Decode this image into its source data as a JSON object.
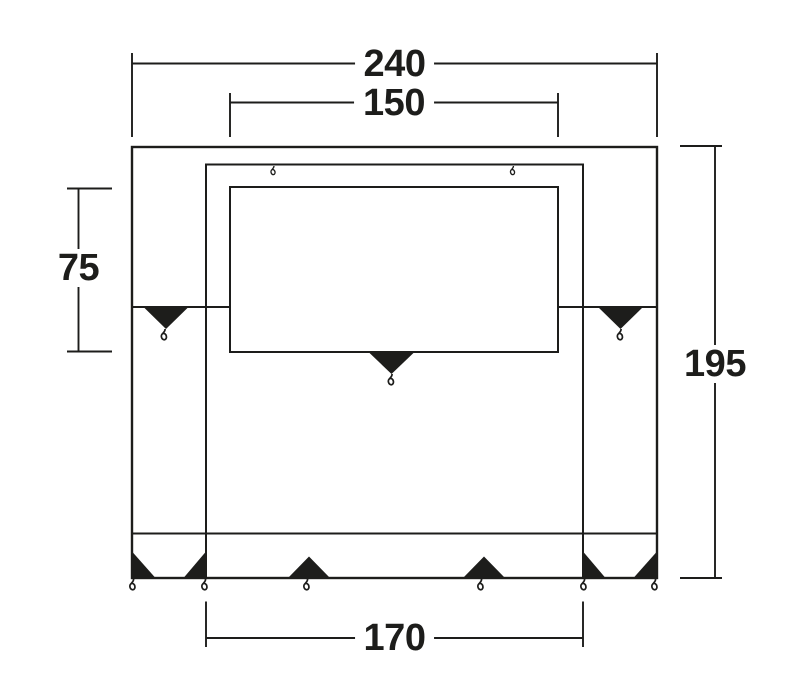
{
  "diagram": {
    "kind": "technical-dimension-drawing",
    "dimensions": {
      "total_width": "240",
      "front_window_width": "150",
      "cabin_depth": "75",
      "total_depth": "195",
      "rear_width": "170"
    }
  },
  "icons": {
    "peg": "black-triangle-peg-marker",
    "hook": "peg-ring-hook"
  },
  "colors": {
    "line": "#1d1d1b",
    "background": "#ffffff"
  }
}
